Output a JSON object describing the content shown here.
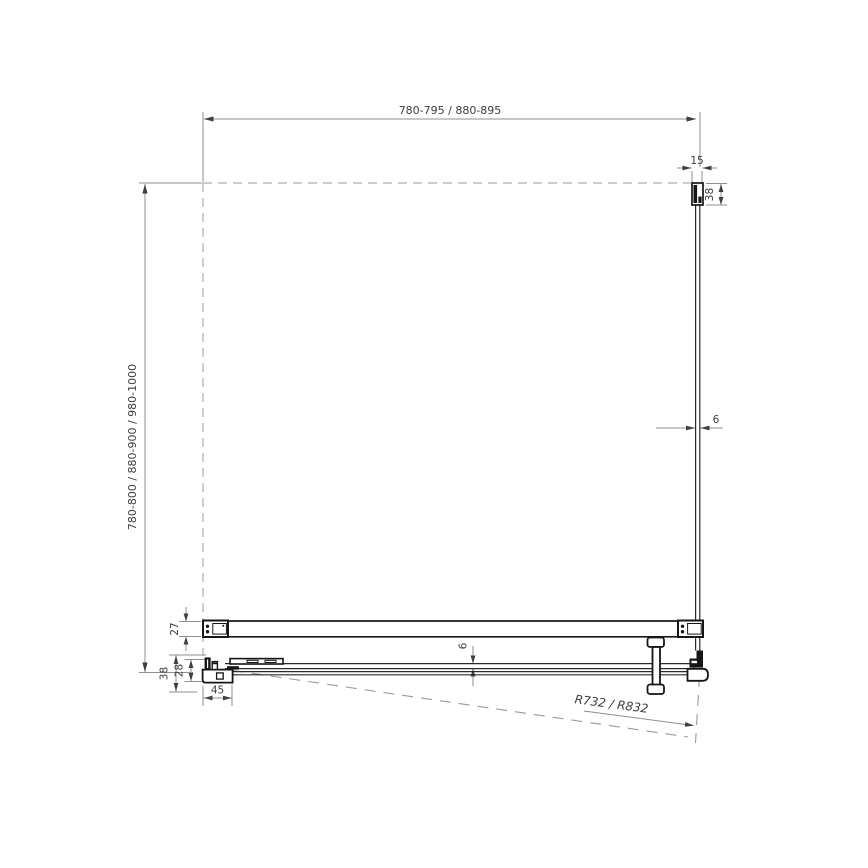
{
  "dims": {
    "width_top": "780-795 / 880-895",
    "depth_left": "780-800 / 880-900 / 980-1000",
    "profile_width": "15",
    "profile_depth": "38",
    "glass_thickness": "6",
    "bar_depth": "27",
    "sill_height": "38",
    "sill_inner_height": "28",
    "sill_depth": "45",
    "door_glass_thickness": "6",
    "swing_radius": "R732 / R832"
  }
}
